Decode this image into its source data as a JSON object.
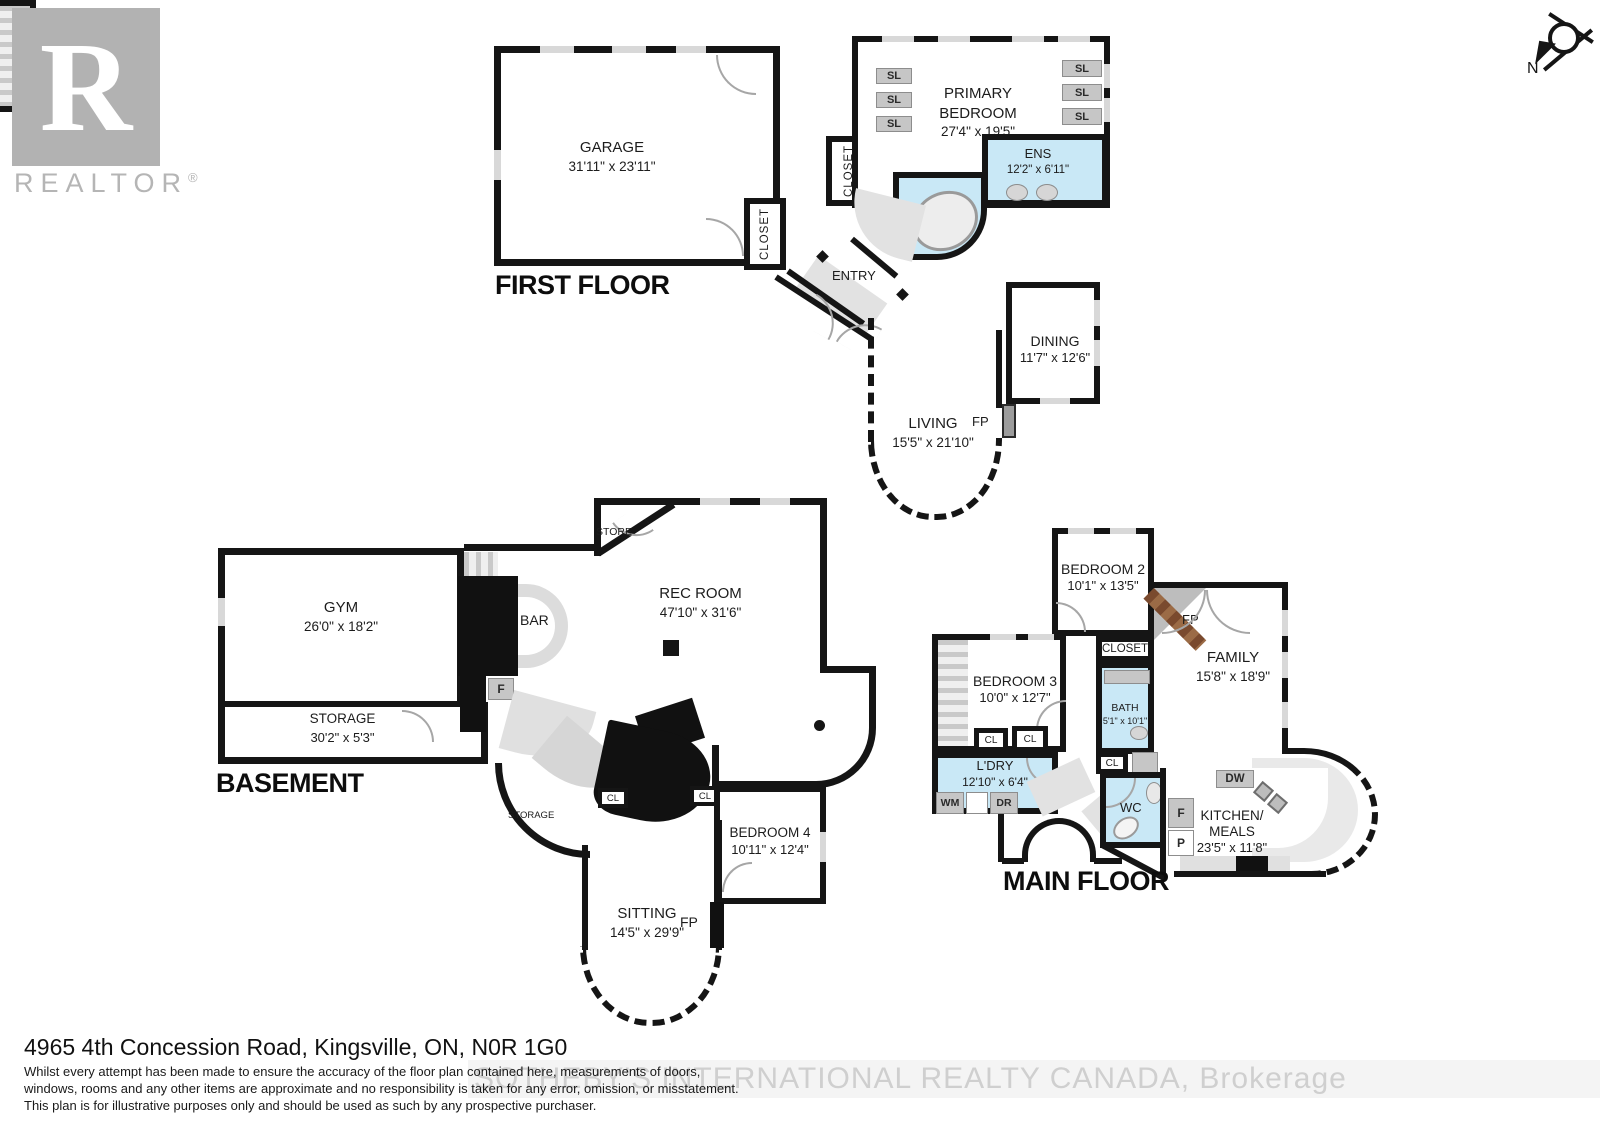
{
  "branding": {
    "logo_letter": "R",
    "logo_word": "REALTOR",
    "registered": "®"
  },
  "compass": {
    "north": "N"
  },
  "colors": {
    "wall": "#151515",
    "wet_area": "#c9e8f6",
    "fireplace_brown": "#8a5a3a",
    "watermark_gray": "#cfcfcf",
    "logo_gray": "#b2b2b2"
  },
  "abbr": {
    "sl": "SL",
    "cl": "CL",
    "fp": "FP",
    "f": "F",
    "p": "P",
    "wm": "WM",
    "dr": "DR",
    "dw": "DW",
    "wc": "WC",
    "bar": "BAR",
    "store": "STORE",
    "storage": "STORAGE",
    "closet": "CLOSET",
    "entry": "ENTRY"
  },
  "first_floor": {
    "title": "FIRST FLOOR",
    "garage_name": "GARAGE",
    "garage_dims": "31'11\" x 23'11\"",
    "primary_line1": "PRIMARY",
    "primary_line2": "BEDROOM",
    "primary_dims": "27'4\" x 19'5\"",
    "ens_name": "ENS",
    "ens_dims": "12'2\" x 6'11\"",
    "dining_name": "DINING",
    "dining_dims": "11'7\" x 12'6\"",
    "living_name": "LIVING",
    "living_dims": "15'5\" x 21'10\""
  },
  "main_floor": {
    "title": "MAIN FLOOR",
    "bedroom2_name": "BEDROOM 2",
    "bedroom2_dims": "10'1\" x 13'5\"",
    "bedroom3_name": "BEDROOM 3",
    "bedroom3_dims": "10'0\" x 12'7\"",
    "bath_name": "BATH",
    "bath_dims": "5'1\" x 10'1\"",
    "family_name": "FAMILY",
    "family_dims": "15'8\" x 18'9\"",
    "ldry_name": "L'DRY",
    "ldry_dims": "12'10\" x 6'4\"",
    "kitchen_line1": "KITCHEN/",
    "kitchen_line2": "MEALS",
    "kitchen_dims": "23'5\" x 11'8\""
  },
  "basement": {
    "title": "BASEMENT",
    "gym_name": "GYM",
    "gym_dims": "26'0\" x 18'2\"",
    "storage_name": "STORAGE",
    "storage_dims": "30'2\" x 5'3\"",
    "rec_name": "REC ROOM",
    "rec_dims": "47'10\" x 31'6\"",
    "bedroom4_name": "BEDROOM 4",
    "bedroom4_dims": "10'11\" x 12'4\"",
    "sitting_name": "SITTING",
    "sitting_dims": "14'5\" x 29'9\""
  },
  "footer": {
    "address": "4965 4th Concession Road, Kingsville, ON, N0R 1G0",
    "disclaimer_line1": "Whilst every attempt has been made to ensure the accuracy of the floor plan contained here, measurements of doors,",
    "disclaimer_line2": "windows, rooms and any other items are approximate and no responsibility is taken for any error, omission, or misstatement.",
    "disclaimer_line3": "This plan is for illustrative purposes only and should be used as such by any prospective purchaser.",
    "watermark": "SOTHEBY'S INTERNATIONAL REALTY CANADA, Brokerage"
  }
}
